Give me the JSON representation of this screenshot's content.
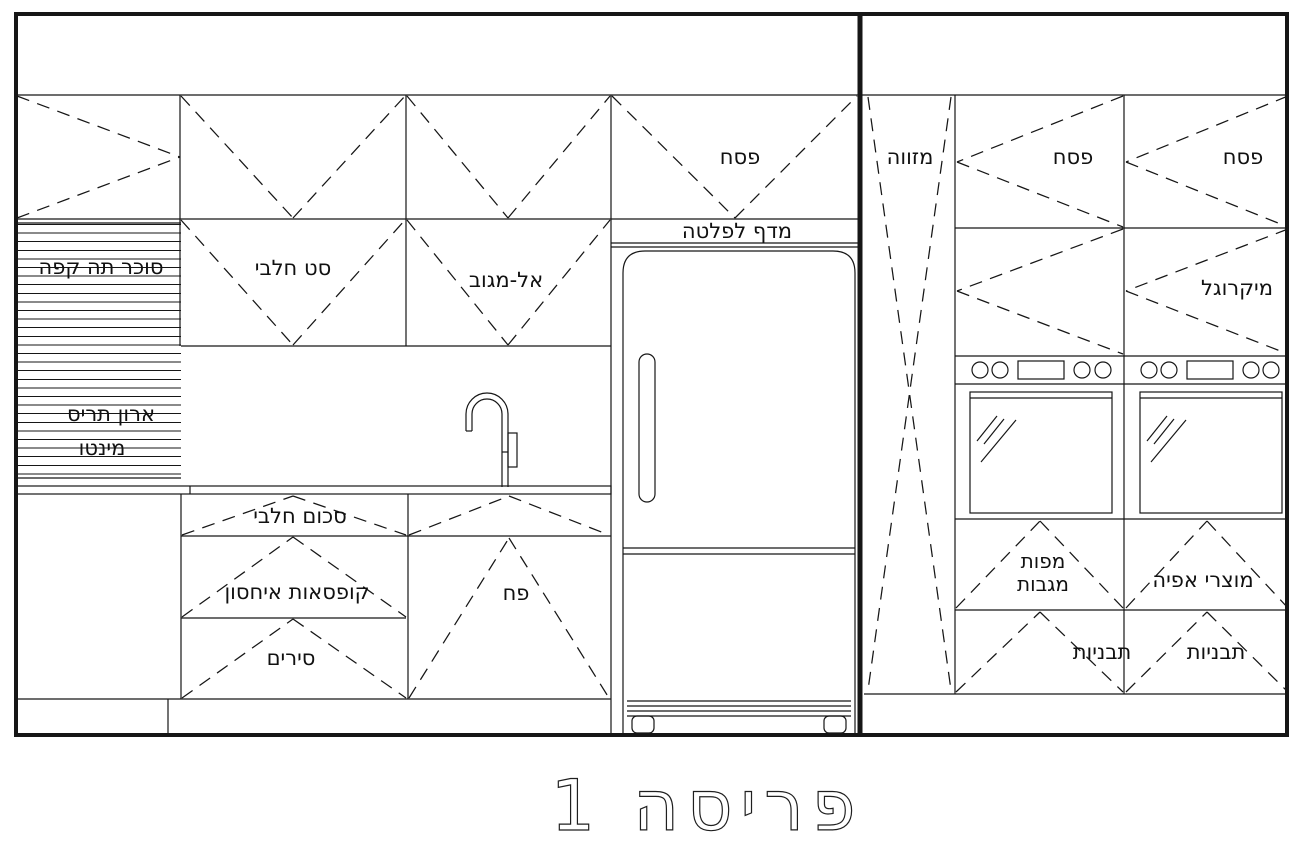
{
  "drawing": {
    "title": "פריסה 1",
    "left_wall": {
      "tall_cabinet": {
        "top_label": "סוכר תה קפה",
        "mid_label": "ארון תריס",
        "bottom_label": "מינטו"
      },
      "upper": {
        "dairy_set": "סט חלבי",
        "almagov": "אל-מגוב",
        "pesach": "פסח",
        "hotplate_shelf": "מדף לפלטה"
      },
      "base": {
        "dairy_cutlery": "סכום חלבי",
        "storage_boxes": "קופסאות איחסון",
        "pots": "סירים",
        "trash_bin": "פח"
      }
    },
    "right_wall": {
      "pantry": "מזווה",
      "upper": {
        "pesach_left": "פסח",
        "pesach_right": "פסח",
        "microwave": "מיקרוגל"
      },
      "base": {
        "towels_line1": "מפות",
        "towels_line2": "מגבות",
        "baking": "מוצרי אפיה",
        "trays_left": "תבניות",
        "trays_right": "תבניות"
      }
    }
  }
}
